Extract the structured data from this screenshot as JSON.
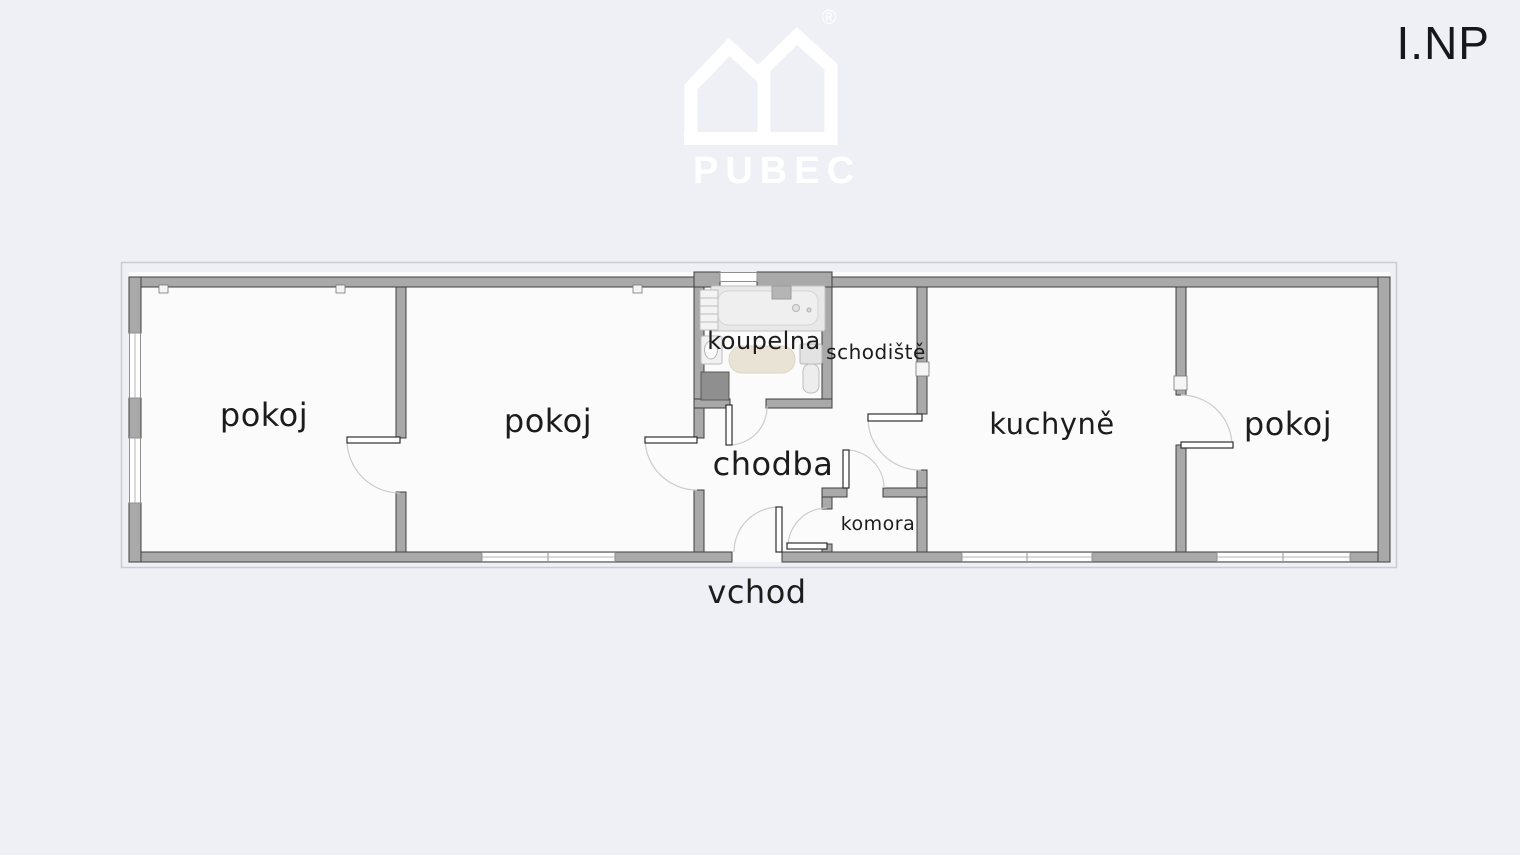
{
  "floor_title": "I.NP",
  "watermark": {
    "brand": "PUBEC",
    "registered_mark": "®"
  },
  "rooms": {
    "room1": "pokoj",
    "room2": "pokoj",
    "bathroom": "koupelna",
    "staircase": "schodiště",
    "hallway": "chodba",
    "pantry": "komora",
    "kitchen": "kuchyně",
    "room3": "pokoj"
  },
  "entrance_label": "vchod",
  "colors": {
    "background": "#eef0f5",
    "room_fill": "#fbfbfb",
    "wall_fill": "#a9a9a9",
    "wall_outline": "#3f3f3f",
    "label_text": "#1c1c1c",
    "watermark": "#ffffff",
    "door_arc": "#cccccc",
    "rug": "#e9e3d6",
    "appliance_dark": "#8f8f8f"
  }
}
